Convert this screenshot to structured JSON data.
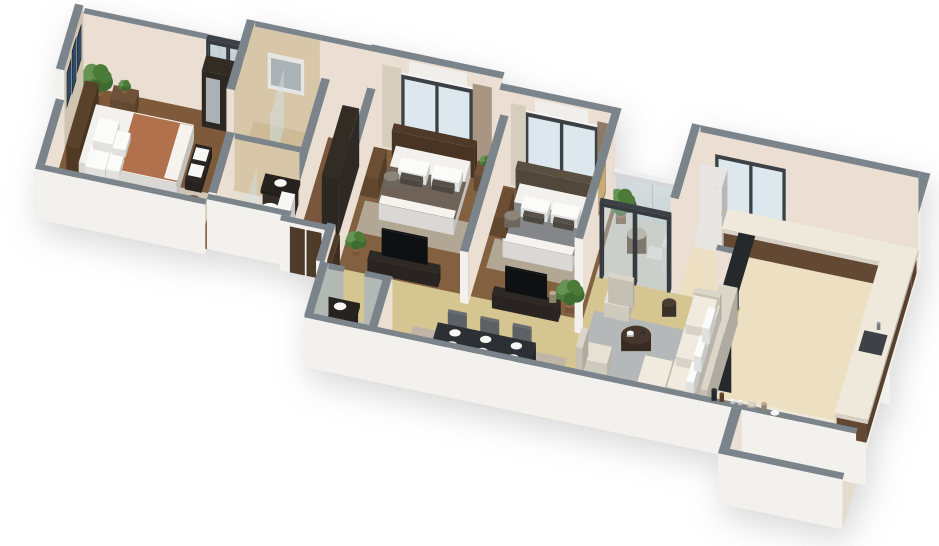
{
  "scene": {
    "label": "3D isometric cutaway floor plan render of a three-bedroom apartment",
    "background": "#ffffff"
  },
  "rooms": [
    "master-bedroom",
    "master-balcony",
    "shower-bathroom",
    "toilet-bathroom",
    "wardrobe-corridor",
    "bedroom-2",
    "bedroom-3",
    "balcony",
    "living-room",
    "dining-area",
    "guest-bathroom",
    "kitchen",
    "utility-balcony",
    "entrance-hall"
  ],
  "palette": {
    "wallTop": "#7b838b",
    "extWall": "#f2f1ee",
    "intWall": "#eadfd2",
    "accentWall": "#cfc3b2",
    "marbleWall": "#d7c6a7",
    "marbleFloor": "#cdbb97",
    "granite": "#39414a",
    "tileWallGray": "#b2b8b4",
    "tileFloorGray": "#b7bcb8",
    "woodA": "#7e5a3b",
    "woodB": "#83603f",
    "woodC": "#7a573c",
    "hallMarble": "#d5c591",
    "kitchenTile": "#ecdfc2",
    "balcFloor": "#d8d0c2",
    "mbalFloor": "#ccc5b7",
    "utilFloor": "#e3dbcb",
    "tbFloor": "#e5ded2",
    "rugMB": "#cfc6b6",
    "rugBed": "#b2a795",
    "rugLR": "#b4b8b8",
    "rugDine": "#c0b5a6",
    "white": "#f7f7f5",
    "mattress": "#f3f1ed",
    "pillow": "#fbfbf9",
    "pillowDark": "#555049",
    "blanketMB": "#b0714c",
    "sheetWhite": "#f6f3ee",
    "blanketB2": "#6f6258",
    "blanketB3": "#85868a",
    "headboardA": "#5a4129",
    "headboardB": "#4f3a29",
    "headboardC": "#5a4f41",
    "benchDark": "#2b2623",
    "pouf": "#6b4a33",
    "woodFurn": "#6e5138",
    "deskWood": "#6b4e33",
    "darkUnit": "#2e2925",
    "darkUnit2": "#332c25",
    "counterDark": "#3a332c",
    "counterTop": "#26231f",
    "kcabinet": "#6e5139",
    "kcounterTop": "#efe9dc",
    "cooktop": "#17191b",
    "burner": "#3a3f43",
    "sinkGray": "#3e4246",
    "applianceDark": "#26292c",
    "shelfLight": "#dfe3e5",
    "sofaCream": "#e7e1d4",
    "sofaBack": "#dcd6c9",
    "cushion": "#f0eadf",
    "chairGray": "#70767b",
    "chairBack": "#666c71",
    "chairFabric": "#8c8478",
    "tableDark": "#2c3034",
    "cTableWood": "#46362c",
    "sideTable": "#4a3e33",
    "glass": "#cfe4ec",
    "glassFrame": "#eceeef",
    "frameDark": "#3c4146",
    "frameWhite": "#f3f3f1",
    "winGlass": "#dce8ed",
    "curtainL": "#d6cdbd",
    "curtainR": "#a89582",
    "curtainR2": "#8d7a66",
    "ac": "#f0efec",
    "artNavy": "#2c4a6b",
    "artFrame": "#23262b",
    "artGold": "#c9ab74",
    "artGoldFr": "#8a7a5a",
    "artPale": "#d9cdbc",
    "doorWood": "#4e3b2a",
    "potTerra": "#9a6b4c",
    "green1": "#4c7a38",
    "green2": "#679455",
    "green3": "#3e6b30",
    "chairBal": "#efe9dd",
    "bottleDark": "#2f3338",
    "bottleBrown": "#6b4a2f",
    "wine": "#27422c",
    "bowl": "#d9d2c6",
    "jar": "#b9a88f",
    "metal": "#9aa0a4",
    "tvBlack": "#101214",
    "mirror": "#aab2b6",
    "cabinetFace": "#e8e6e2",
    "fridge": "#e8e6e2",
    "grainLine": "rgba(72,44,24,0.25)",
    "tileLine": "#d9cba8",
    "tileLineGray": "#c9cec9",
    "tbLine": "#d8d1c5",
    "balcLine": "#cbc4b6"
  }
}
